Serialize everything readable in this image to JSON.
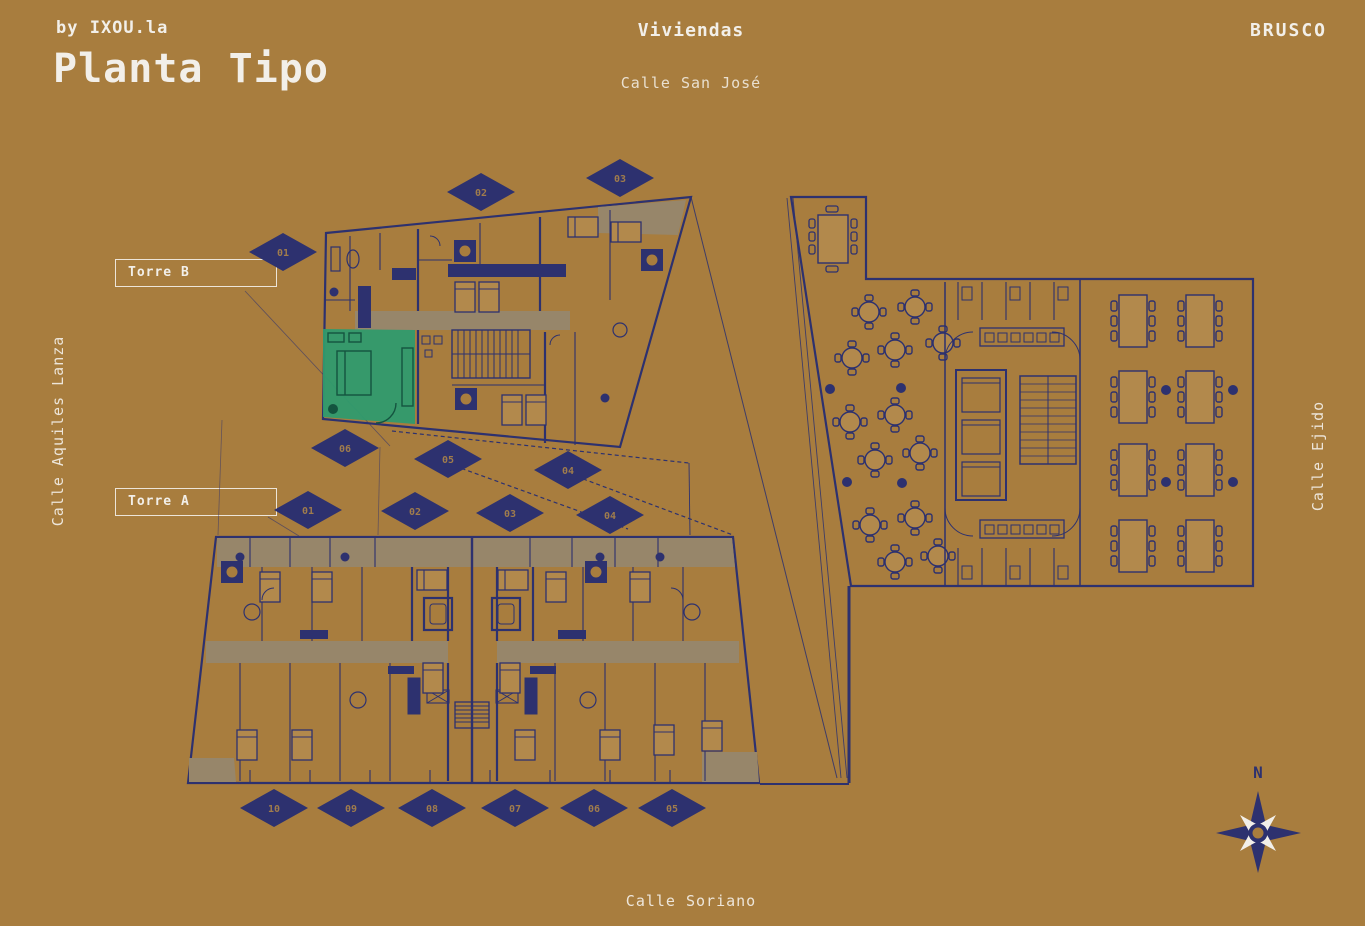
{
  "header": {
    "byline": "by IXOU.la",
    "title": "Planta Tipo",
    "category_label": "Viviendas",
    "brand": "BRUSCO"
  },
  "streets": {
    "top": "Calle San José",
    "left": "Calle Aquiles Lanza",
    "right": "Calle Ejido",
    "bottom": "Calle Soriano"
  },
  "towers": {
    "torre_b": {
      "label": "Torre B"
    },
    "torre_a": {
      "label": "Torre A"
    }
  },
  "unit_markers": {
    "torre_b_top": [
      {
        "label": "01"
      },
      {
        "label": "02"
      },
      {
        "label": "03"
      }
    ],
    "torre_b_inner": [
      {
        "label": "06"
      },
      {
        "label": "05"
      },
      {
        "label": "04"
      }
    ],
    "torre_a_inner": [
      {
        "label": "01"
      },
      {
        "label": "02"
      },
      {
        "label": "03"
      },
      {
        "label": "04"
      }
    ],
    "torre_a_bottom": [
      {
        "label": "10"
      },
      {
        "label": "09"
      },
      {
        "label": "08"
      },
      {
        "label": "07"
      },
      {
        "label": "06"
      },
      {
        "label": "05"
      }
    ]
  },
  "compass": {
    "north_label": "N"
  },
  "highlighted_unit": {
    "tower_label": "Torre B",
    "highlight_color": "#2f9b6e"
  },
  "colors": {
    "background": "#a87d3e",
    "plan_line": "#2d316f",
    "band_grey": "#97866a",
    "furniture_tan": "#b2894c",
    "marker_fill": "#2d316f",
    "marker_text": "#a07c4c",
    "text_white": "#f2efe9",
    "highlight_green": "#2f9b6e"
  }
}
